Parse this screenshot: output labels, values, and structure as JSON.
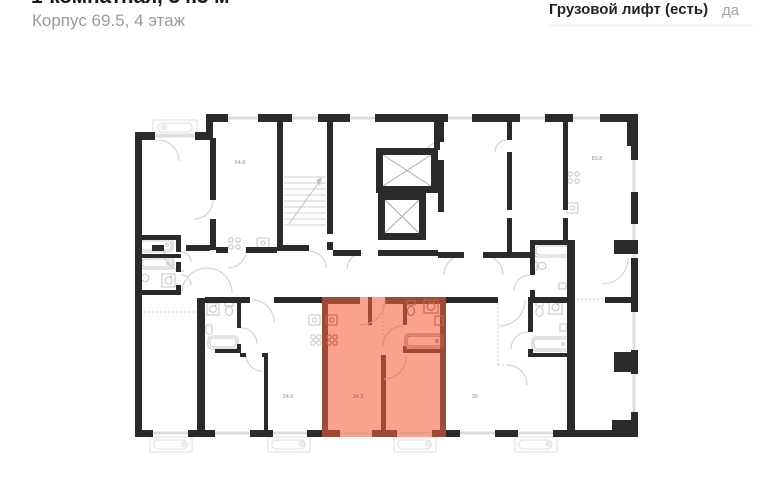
{
  "header": {
    "title": "1-комнатная, 34.3 м²",
    "subtitle": "Корпус 69.5, 4 этаж"
  },
  "info_panel": {
    "label": "Грузовой лифт (есть)",
    "value": "да"
  },
  "floor_plan": {
    "apartments": [
      {
        "name": "apartment-64-8",
        "area": "64.8",
        "highlighted": false
      },
      {
        "name": "apartment-83-8",
        "area": "83.8",
        "highlighted": false
      },
      {
        "name": "apartment-34-6",
        "area": "34.6",
        "highlighted": false
      },
      {
        "name": "apartment-34-3",
        "area": "34.3",
        "highlighted": true
      },
      {
        "name": "apartment-35",
        "area": "35",
        "highlighted": false
      }
    ],
    "colors": {
      "wall": "#2a2a2a",
      "highlight_wall": "#9d4b38",
      "highlight_fill": "#faa28d",
      "highlight_label": "#a85a43",
      "window": "#dddddd",
      "label": "#909090"
    }
  }
}
